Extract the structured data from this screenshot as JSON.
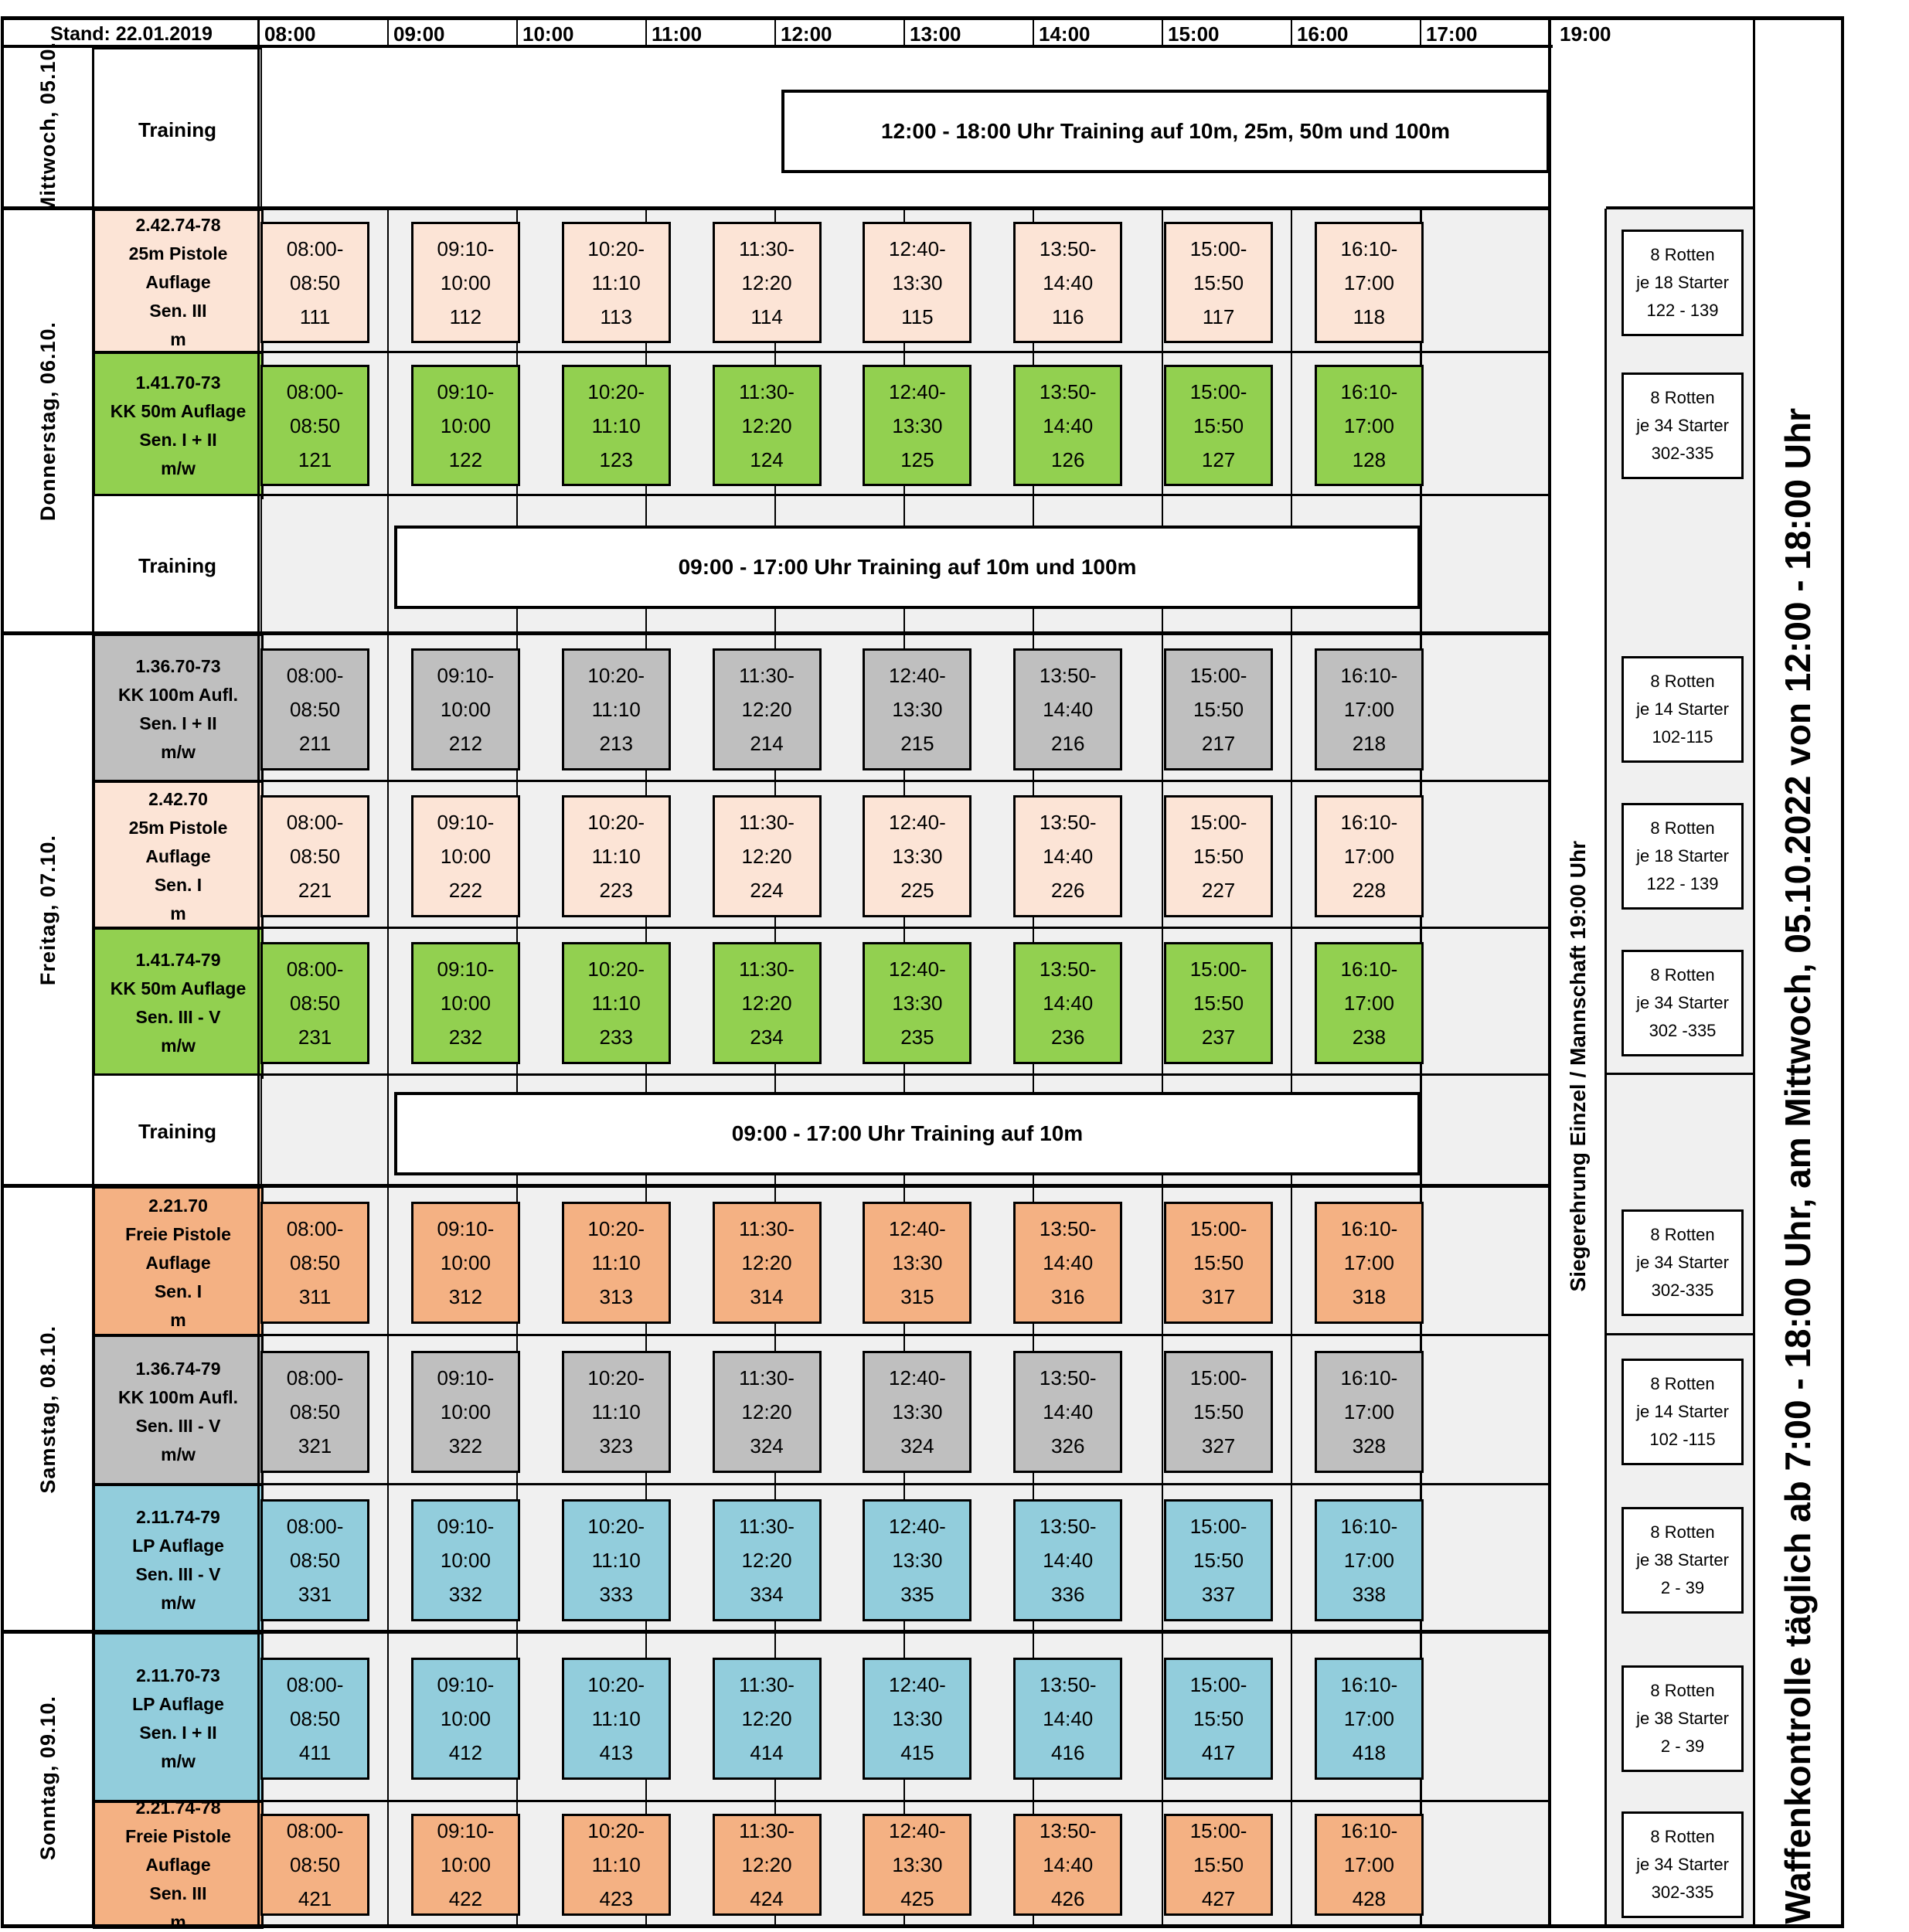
{
  "header": {
    "stand_label": "Stand: 22.01.2019",
    "time_labels": [
      "08:00",
      "09:00",
      "10:00",
      "11:00",
      "12:00",
      "13:00",
      "14:00",
      "15:00",
      "16:00",
      "17:00",
      "19:00"
    ]
  },
  "side": {
    "siegerehrung": "Siegerehrung Einzel / Mannschaft 19:00 Uhr",
    "waffenkontrolle": "Waffenkontrolle täglich ab 7:00 - 18:00 Uhr, am Mittwoch, 05.10.2022 von 12:00 - 18:00 Uhr"
  },
  "colors": {
    "peach": "#fce4d6",
    "green": "#92d050",
    "gray": "#bfbfbf",
    "orange": "#f4b183",
    "blue": "#92cddc"
  },
  "days": [
    {
      "label": "Mittwoch, 05.10.",
      "rows": [
        {
          "type": "training",
          "label": "Training",
          "banner": {
            "text": "12:00 - 18:00 Uhr Training auf 10m, 25m, 50m und 100m",
            "start": "12:00",
            "end": "18:00"
          }
        }
      ]
    },
    {
      "label": "Donnerstag, 06.10.",
      "rows": [
        {
          "type": "event",
          "color": "peach",
          "lines": [
            "2.42.74-78",
            "25m Pistole Auflage",
            "Sen. III",
            "m"
          ],
          "slots": [
            {
              "time": "08:00-08:50",
              "num": "111"
            },
            {
              "time": "09:10-10:00",
              "num": "112"
            },
            {
              "time": "10:20-11:10",
              "num": "113"
            },
            {
              "time": "11:30-12:20",
              "num": "114"
            },
            {
              "time": "12:40-13:30",
              "num": "115"
            },
            {
              "time": "13:50-14:40",
              "num": "116"
            },
            {
              "time": "15:00-15:50",
              "num": "117"
            },
            {
              "time": "16:10-17:00",
              "num": "118"
            }
          ],
          "rotten": [
            "8 Rotten",
            "je 18 Starter",
            "122 - 139"
          ]
        },
        {
          "type": "event",
          "color": "green",
          "lines": [
            "1.41.70-73",
            "KK 50m Auflage",
            "Sen. I + II",
            "m/w"
          ],
          "slots": [
            {
              "time": "08:00-08:50",
              "num": "121"
            },
            {
              "time": "09:10-10:00",
              "num": "122"
            },
            {
              "time": "10:20-11:10",
              "num": "123"
            },
            {
              "time": "11:30-12:20",
              "num": "124"
            },
            {
              "time": "12:40-13:30",
              "num": "125"
            },
            {
              "time": "13:50-14:40",
              "num": "126"
            },
            {
              "time": "15:00-15:50",
              "num": "127"
            },
            {
              "time": "16:10-17:00",
              "num": "128"
            }
          ],
          "rotten": [
            "8 Rotten",
            "je 34 Starter",
            "302-335"
          ]
        },
        {
          "type": "training",
          "label": "Training",
          "banner": {
            "text": "09:00 - 17:00 Uhr Training auf 10m und 100m",
            "start": "09:00",
            "end": "17:00"
          }
        }
      ]
    },
    {
      "label": "Freitag, 07.10.",
      "rows": [
        {
          "type": "event",
          "color": "gray",
          "lines": [
            "1.36.70-73",
            "KK 100m Aufl.",
            "Sen. I + II",
            "m/w"
          ],
          "slots": [
            {
              "time": "08:00-08:50",
              "num": "211"
            },
            {
              "time": "09:10-10:00",
              "num": "212"
            },
            {
              "time": "10:20-11:10",
              "num": "213"
            },
            {
              "time": "11:30-12:20",
              "num": "214"
            },
            {
              "time": "12:40-13:30",
              "num": "215"
            },
            {
              "time": "13:50-14:40",
              "num": "216"
            },
            {
              "time": "15:00-15:50",
              "num": "217"
            },
            {
              "time": "16:10-17:00",
              "num": "218"
            }
          ],
          "rotten": [
            "8 Rotten",
            "je 14 Starter",
            "102-115"
          ]
        },
        {
          "type": "event",
          "color": "peach",
          "lines": [
            "2.42.70",
            "25m Pistole Auflage",
            "Sen. I",
            "m"
          ],
          "slots": [
            {
              "time": "08:00-08:50",
              "num": "221"
            },
            {
              "time": "09:10-10:00",
              "num": "222"
            },
            {
              "time": "10:20-11:10",
              "num": "223"
            },
            {
              "time": "11:30-12:20",
              "num": "224"
            },
            {
              "time": "12:40-13:30",
              "num": "225"
            },
            {
              "time": "13:50-14:40",
              "num": "226"
            },
            {
              "time": "15:00-15:50",
              "num": "227"
            },
            {
              "time": "16:10-17:00",
              "num": "228"
            }
          ],
          "rotten": [
            "8 Rotten",
            "je 18 Starter",
            "122 - 139"
          ]
        },
        {
          "type": "event",
          "color": "green",
          "lines": [
            "1.41.74-79",
            "KK 50m Auflage",
            "Sen. III - V",
            "m/w"
          ],
          "slots": [
            {
              "time": "08:00-08:50",
              "num": "231"
            },
            {
              "time": "09:10-10:00",
              "num": "232"
            },
            {
              "time": "10:20-11:10",
              "num": "233"
            },
            {
              "time": "11:30-12:20",
              "num": "234"
            },
            {
              "time": "12:40-13:30",
              "num": "235"
            },
            {
              "time": "13:50-14:40",
              "num": "236"
            },
            {
              "time": "15:00-15:50",
              "num": "237"
            },
            {
              "time": "16:10-17:00",
              "num": "238"
            }
          ],
          "rotten": [
            "8 Rotten",
            "je 34 Starter",
            "302 -335"
          ]
        },
        {
          "type": "training",
          "label": "Training",
          "banner": {
            "text": "09:00 - 17:00 Uhr Training auf 10m",
            "start": "09:00",
            "end": "17:00"
          }
        }
      ]
    },
    {
      "label": "Samstag, 08.10.",
      "rows": [
        {
          "type": "event",
          "color": "orange",
          "lines": [
            "2.21.70",
            "Freie Pistole Auflage",
            "Sen. I",
            "m"
          ],
          "slots": [
            {
              "time": "08:00-08:50",
              "num": "311"
            },
            {
              "time": "09:10-10:00",
              "num": "312"
            },
            {
              "time": "10:20-11:10",
              "num": "313"
            },
            {
              "time": "11:30-12:20",
              "num": "314"
            },
            {
              "time": "12:40-13:30",
              "num": "315"
            },
            {
              "time": "13:50-14:40",
              "num": "316"
            },
            {
              "time": "15:00-15:50",
              "num": "317"
            },
            {
              "time": "16:10-17:00",
              "num": "318"
            }
          ],
          "rotten": [
            "8 Rotten",
            "je 34 Starter",
            "302-335"
          ]
        },
        {
          "type": "event",
          "color": "gray",
          "lines": [
            "1.36.74-79",
            "KK 100m Aufl.",
            "Sen. III - V",
            "m/w"
          ],
          "slots": [
            {
              "time": "08:00-08:50",
              "num": "321"
            },
            {
              "time": "09:10-10:00",
              "num": "322"
            },
            {
              "time": "10:20-11:10",
              "num": "323"
            },
            {
              "time": "11:30-12:20",
              "num": "324"
            },
            {
              "time": "12:40-13:30",
              "num": "324"
            },
            {
              "time": "13:50-14:40",
              "num": "326"
            },
            {
              "time": "15:00-15:50",
              "num": "327"
            },
            {
              "time": "16:10-17:00",
              "num": "328"
            }
          ],
          "rotten": [
            "8 Rotten",
            "je 14 Starter",
            "102 -115"
          ]
        },
        {
          "type": "event",
          "color": "blue",
          "lines": [
            "2.11.74-79",
            "LP Auflage",
            "Sen. III - V",
            "m/w"
          ],
          "slots": [
            {
              "time": "08:00-08:50",
              "num": "331"
            },
            {
              "time": "09:10-10:00",
              "num": "332"
            },
            {
              "time": "10:20-11:10",
              "num": "333"
            },
            {
              "time": "11:30-12:20",
              "num": "334"
            },
            {
              "time": "12:40-13:30",
              "num": "335"
            },
            {
              "time": "13:50-14:40",
              "num": "336"
            },
            {
              "time": "15:00-15:50",
              "num": "337"
            },
            {
              "time": "16:10-17:00",
              "num": "338"
            }
          ],
          "rotten": [
            "8 Rotten",
            "je 38 Starter",
            "2 - 39"
          ]
        }
      ]
    },
    {
      "label": "Sonntag, 09.10.",
      "rows": [
        {
          "type": "event",
          "color": "blue",
          "lines": [
            "2.11.70-73",
            "LP Auflage",
            "Sen. I + II",
            "m/w"
          ],
          "slots": [
            {
              "time": "08:00-08:50",
              "num": "411"
            },
            {
              "time": "09:10-10:00",
              "num": "412"
            },
            {
              "time": "10:20-11:10",
              "num": "413"
            },
            {
              "time": "11:30-12:20",
              "num": "414"
            },
            {
              "time": "12:40-13:30",
              "num": "415"
            },
            {
              "time": "13:50-14:40",
              "num": "416"
            },
            {
              "time": "15:00-15:50",
              "num": "417"
            },
            {
              "time": "16:10-17:00",
              "num": "418"
            }
          ],
          "rotten": [
            "8 Rotten",
            "je 38 Starter",
            "2 - 39"
          ]
        },
        {
          "type": "event",
          "color": "orange",
          "lines": [
            "2.21.74-78",
            "Freie Pistole Auflage",
            "Sen. III",
            "m"
          ],
          "slots": [
            {
              "time": "08:00-08:50",
              "num": "421"
            },
            {
              "time": "09:10-10:00",
              "num": "422"
            },
            {
              "time": "10:20-11:10",
              "num": "423"
            },
            {
              "time": "11:30-12:20",
              "num": "424"
            },
            {
              "time": "12:40-13:30",
              "num": "425"
            },
            {
              "time": "13:50-14:40",
              "num": "426"
            },
            {
              "time": "15:00-15:50",
              "num": "427"
            },
            {
              "time": "16:10-17:00",
              "num": "428"
            }
          ],
          "rotten": [
            "8 Rotten",
            "je 34 Starter",
            "302-335"
          ]
        }
      ]
    }
  ]
}
